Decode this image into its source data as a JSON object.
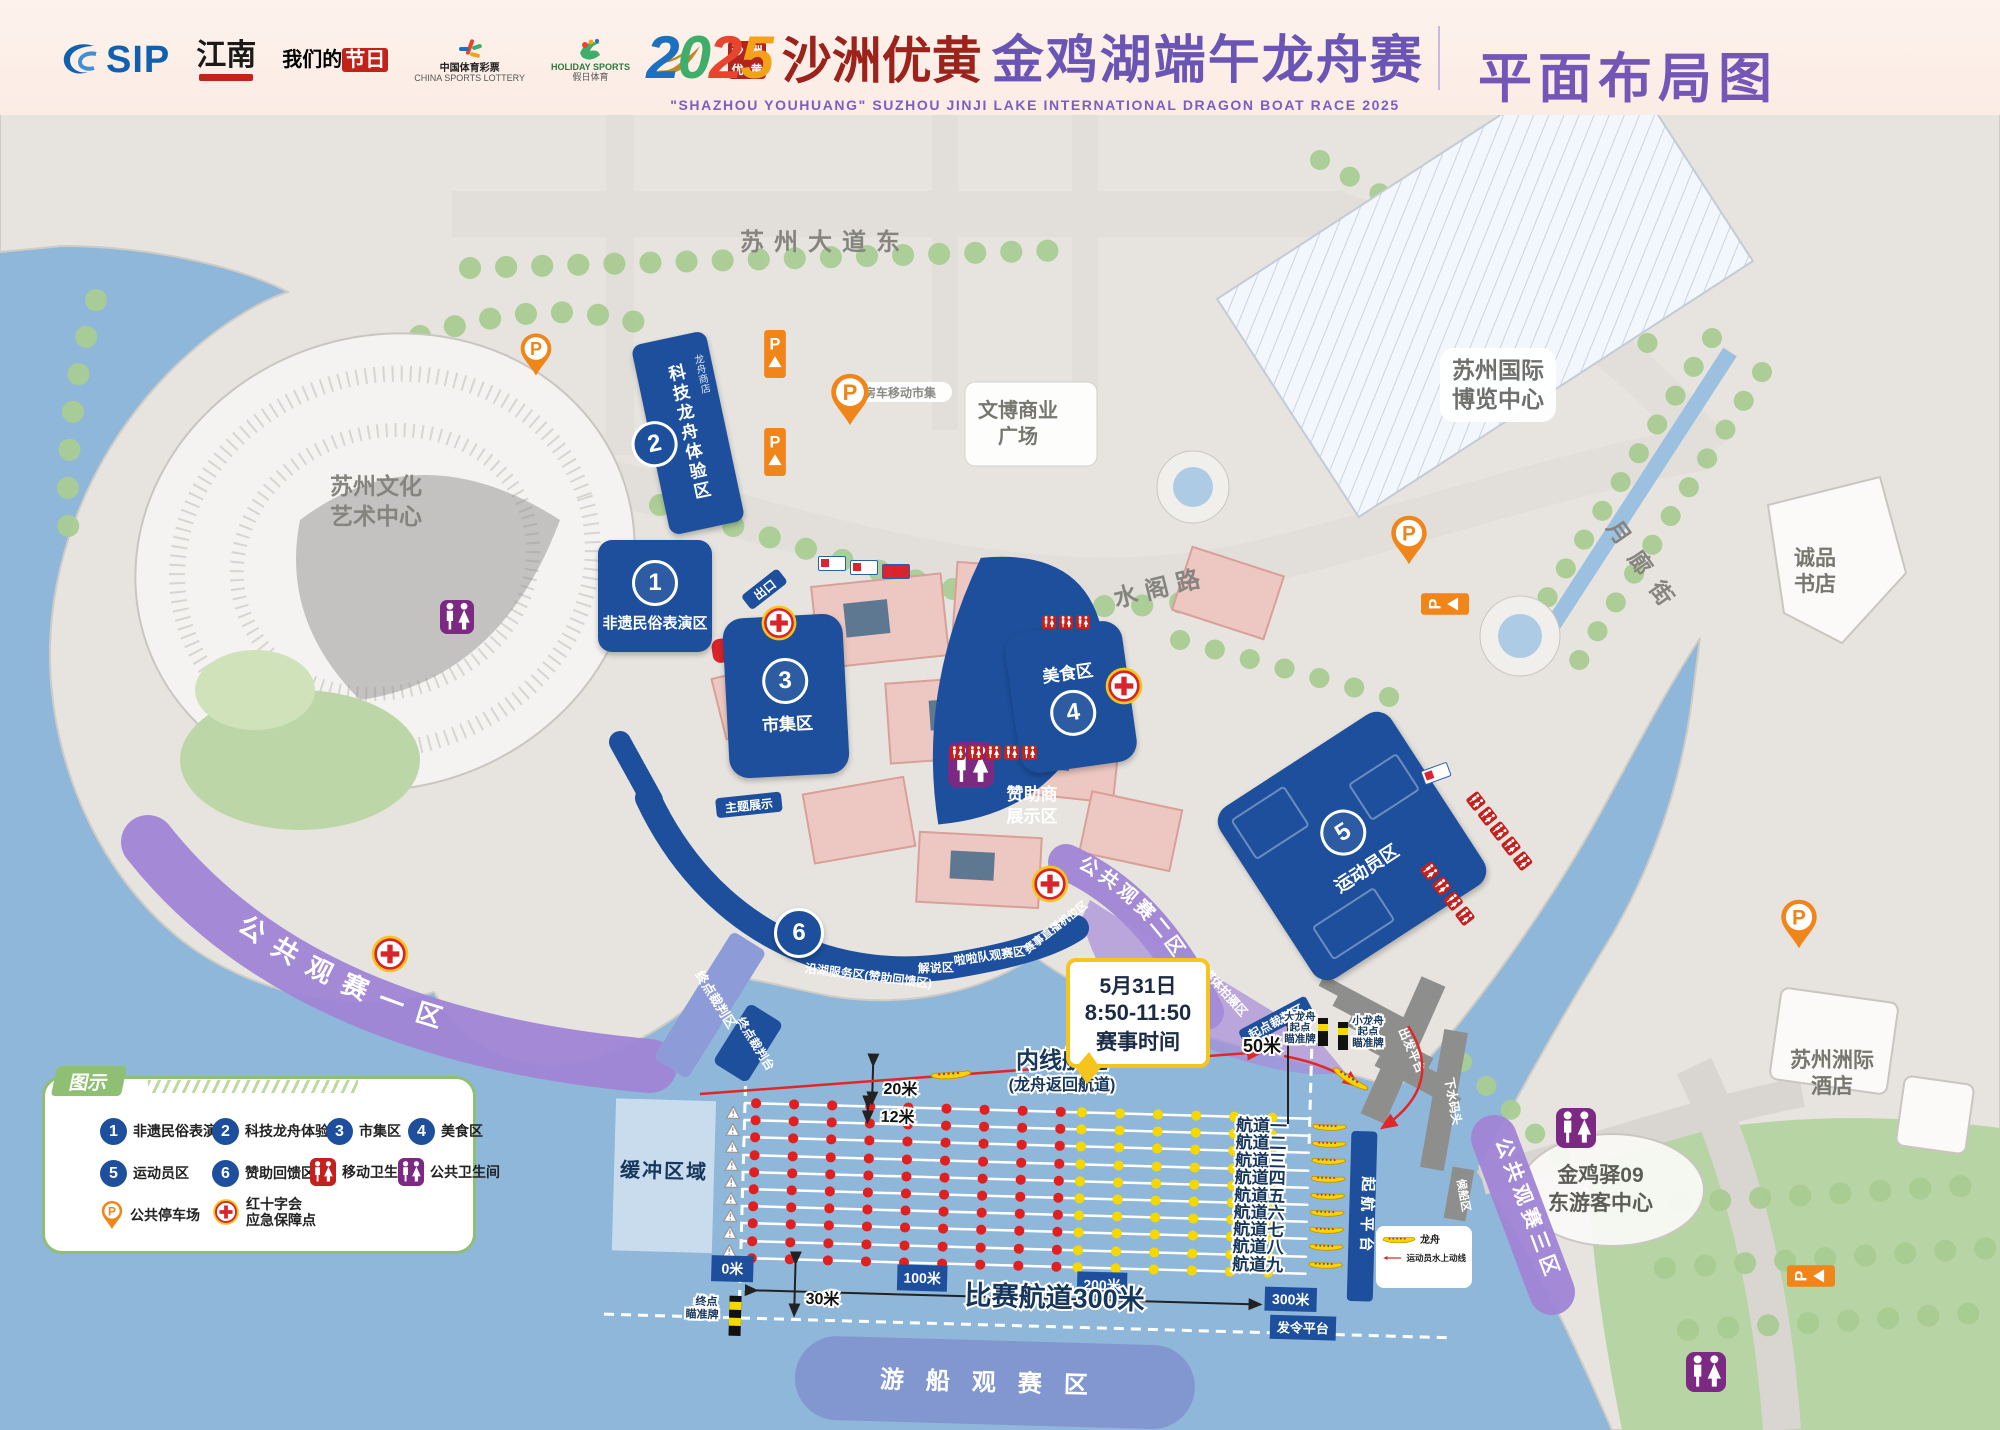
{
  "icons": {
    "p": "P"
  },
  "header": {
    "logos": {
      "sip": "SIP",
      "jiangnan": "江南",
      "festival_pre": "我们的",
      "festival_red": "节日",
      "lottery": "中国体育彩票",
      "lottery_en": "CHINA SPORTS LOTTERY",
      "holiday": "假日体育",
      "holiday_en": "HOLIDAY SPORTS",
      "seal": "沙洲优黄"
    },
    "year": "2025",
    "title_script": "沙洲优黄",
    "title_main": "金鸡湖端午龙舟赛",
    "subtitle_en": "\"SHAZHOU YOUHUANG\" SUZHOU JINJI LAKE INTERNATIONAL DRAGON BOAT RACE 2025",
    "page_label": "平面布局图"
  },
  "legend": {
    "title": "图示",
    "items": [
      {
        "num": "1",
        "label": "非遗民俗表演区"
      },
      {
        "num": "2",
        "label": "科技龙舟体验区"
      },
      {
        "num": "3",
        "label": "市集区"
      },
      {
        "num": "4",
        "label": "美食区"
      },
      {
        "num": "5",
        "label": "运动员区"
      },
      {
        "num": "6",
        "label": "赞助回馈区"
      },
      {
        "icon": "wc-red",
        "label": "移动卫生间"
      },
      {
        "icon": "wc-purple",
        "label": "公共卫生间"
      },
      {
        "icon": "parking",
        "label": "公共停车场"
      },
      {
        "icon": "redcross",
        "label": "红十字会",
        "label2": "应急保障点"
      }
    ]
  },
  "zones": {
    "z1": {
      "num": "1",
      "label": "非遗民俗表演区"
    },
    "z2": {
      "num": "2",
      "label": "科技龙舟体验区",
      "sub": "龙舟商店"
    },
    "z3": {
      "num": "3",
      "label": "市集区"
    },
    "z4": {
      "num": "4",
      "label": "美食区"
    },
    "z5": {
      "num": "5",
      "label": "运动员区"
    },
    "z6": {
      "num": "6"
    }
  },
  "viewing": {
    "v1": "公共观赛一区",
    "v2": "公共观赛二区",
    "v3": "公共观赛三区"
  },
  "waterfront": {
    "service": "沿湖服务区(赞助回馈区)",
    "commentary": "解说区",
    "cheer": "啦啦队观赛区",
    "broadcast": "赛事直播机位区",
    "media": "媒体拍摄区"
  },
  "callout": {
    "date": "5月31日",
    "time": "8:50-11:50",
    "caption": "赛事时间"
  },
  "course": {
    "lanes": [
      "航道一",
      "航道二",
      "航道三",
      "航道四",
      "航道五",
      "航道六",
      "航道七",
      "航道八",
      "航道九"
    ],
    "inner_title": "内线航道",
    "inner_sub": "(龙舟返回航道)",
    "m0": "0米",
    "m100": "100米",
    "m200": "200米",
    "m300": "300米",
    "total": "比赛航道300米",
    "d30": "30米",
    "d20": "20米",
    "d12": "12米",
    "d50": "50米",
    "start_platform": "起航平台",
    "signal_platform": "发令平台",
    "buffer": "缓冲区域",
    "boat_view": "游船观赛区",
    "finish_l1": "终点",
    "finish_l2": "瞄准牌",
    "bigb_l1": "大龙舟",
    "bigb_l2": "起点",
    "bigb_l3": "瞄准牌",
    "smallb_l1": "小龙舟",
    "smallb_l2": "起点",
    "smallb_l3": "瞄准牌",
    "start_judge": "起点裁判区",
    "finish_judge": "终点裁判区",
    "finish_stand": "终点裁判台",
    "legend_boat": "龙舟",
    "legend_route": "运动员水上动线"
  },
  "places": {
    "road_n": "苏州大道东",
    "road_c": "水阁路",
    "road_e": "月廊街",
    "art_l1": "苏州文化",
    "art_l2": "艺术中心",
    "expo_l1": "苏州国际",
    "expo_l2": "博览中心",
    "wenbo_l1": "文博商业",
    "wenbo_l2": "广场",
    "eslite_l1": "诚品",
    "eslite_l2": "书店",
    "hotel_l1": "苏州洲际",
    "hotel_l2": "酒店",
    "visitor_l1": "金鸡驿09",
    "visitor_l2": "东游客中心",
    "sponsor_l1": "赞助商",
    "sponsor_l2": "展示区",
    "service_desk": "服务台",
    "theme": "主题展示",
    "market": "房车移动市集",
    "exit": "出口",
    "pier_depart": "出发平台",
    "pier_launch": "下水码头",
    "pier_wait": "候船区"
  }
}
